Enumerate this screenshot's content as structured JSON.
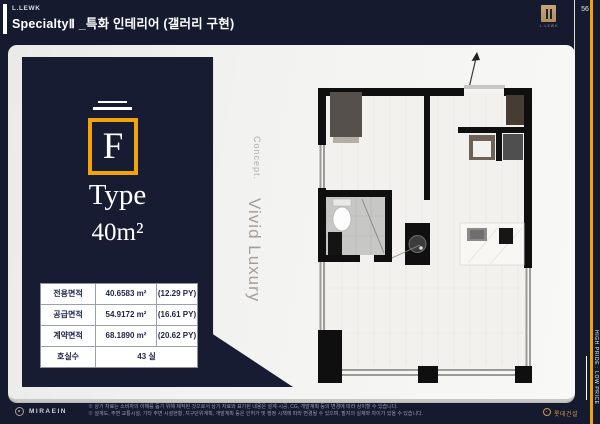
{
  "theme": {
    "navy": "#161a2f",
    "gold": "#f2a30c",
    "card_bg": "#f2f2f0",
    "table_text": "#20264a"
  },
  "header": {
    "brand": "L.LEWK",
    "title": "SpecialtyⅡ _특화 인테리어 (갤러리 구현)",
    "logo_caption": "L.LEWK",
    "page_number": "56"
  },
  "rail": {
    "tagline": "HIGH PRIDE : LOW PRICE"
  },
  "unit": {
    "letter": "F",
    "type_label": "Type",
    "area": "40m²"
  },
  "spec_table": {
    "rows": [
      {
        "label": "전용면적",
        "value": "40.6583 m²",
        "py": "(12.29 PY)"
      },
      {
        "label": "공급면적",
        "value": "54.9172 m²",
        "py": "(16.61 PY)"
      },
      {
        "label": "계약면적",
        "value": "68.1890 m²",
        "py": "(20.62 PY)"
      }
    ],
    "rooms_label": "호실수",
    "rooms_value": "43 실"
  },
  "concept": {
    "eyebrow": "Concept.",
    "title": "Vivid Luxury"
  },
  "footer": {
    "left_brand": "MIRAEIN",
    "disclaimer_line1": "※ 상기 자료는 소비자의 이해를 돕기 위해 제작된 것으로서 상기 자료와 표기된 내용은 설계·시공, CG, 개발계획 등의 변경에 따라 상이할 수 있습니다.",
    "disclaimer_line2": "※ 설계도, 주변 교통시설, 기타 주변 시설현황, 지구단위계획, 개발계획 등은 인허가 및 행정 시책에 따라 변경될 수 있으며, 필지의 실제와 차이가 있을 수 있습니다.",
    "right_brand": "롯데건설"
  }
}
